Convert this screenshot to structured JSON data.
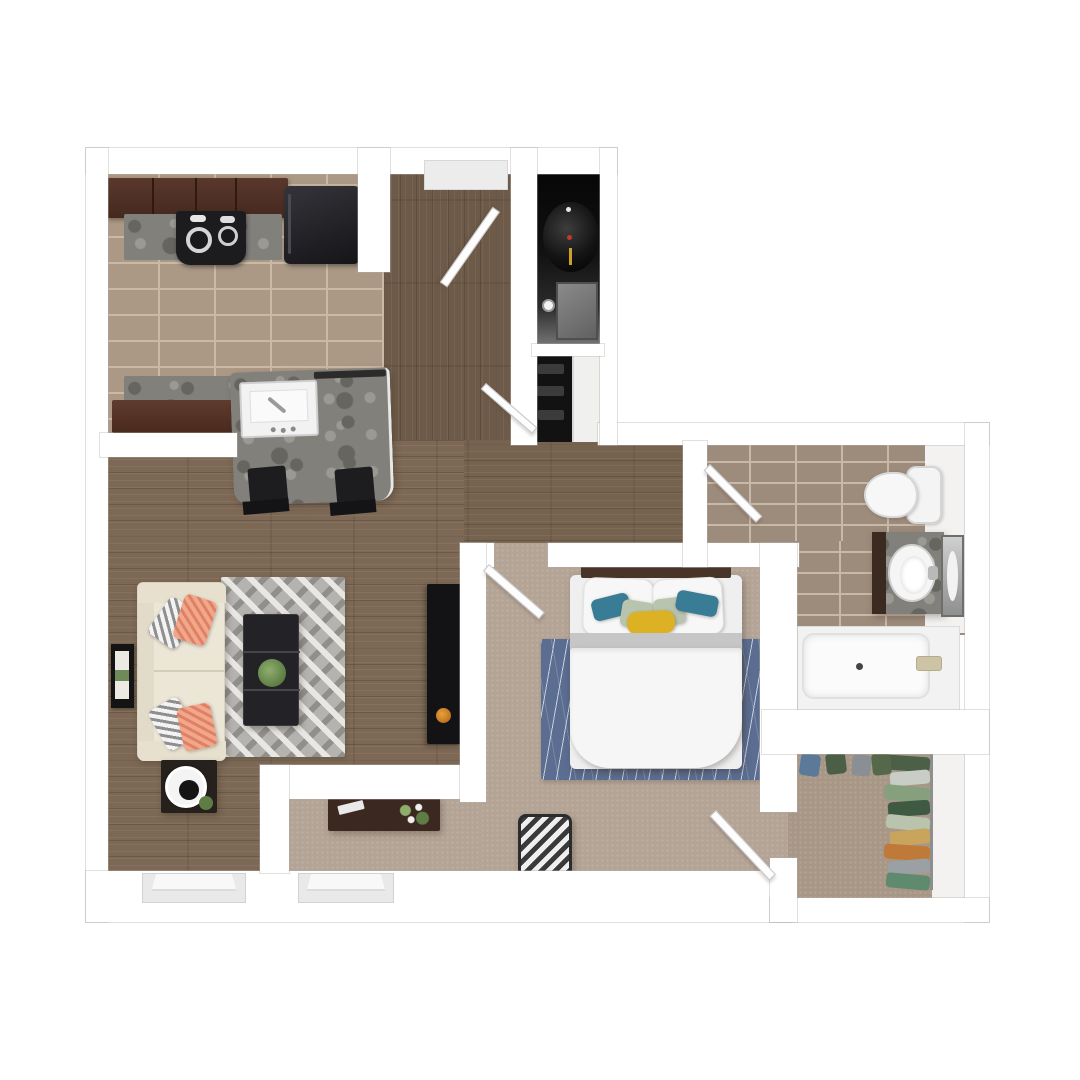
{
  "description": "Top-down 3D rendered floor plan of a one-bedroom apartment; no text labels are visible in the image",
  "visible_text": [],
  "colors": {
    "wall": "#ffffff",
    "wallEdge": "#d8d6d3",
    "woodLiving": "#7c6854",
    "woodEntry": "#6e5a48",
    "woodCorridor": "#76634f",
    "kitchenTile": "#ab9885",
    "kitchenGrout": "#c9b9a7",
    "bathTile": "#9d8b7c",
    "bathGrout": "#c7b8a7",
    "carpet": "#b4a496",
    "closetCarpet": "#a89786",
    "granite": "#82807b",
    "graniteDark": "#67655f",
    "graniteLight": "#9b9993",
    "cabinetDark": "#4a2e26",
    "cabinetMid": "#5a382c",
    "appliance": "#1c1c1f",
    "fridge": "#242428",
    "stool": "#1d1d20",
    "sofa": "#ece6d7",
    "sofaArm": "#e7e0cf",
    "sofaBack": "#e2dbc9",
    "rugGray": "#b5b3b0",
    "rugGrayDark": "#918f8c",
    "rugGrayLight": "#e9e7e4",
    "rugBlue": "#5b6d91",
    "rugBlueLine": "#c6cede",
    "pillowGrayA": "#8f8f8f",
    "pillowGrayB": "#f3f3f3",
    "pillowCoral": "#f2a78c",
    "pillowCoralStripe": "#de8264",
    "pillowTeal": "#397c95",
    "pillowSage": "#b9c4ae",
    "pillowYellow": "#dcb224",
    "headboard": "#483429",
    "furnWood": "#3b2820",
    "tableDark": "#232327",
    "plant": "#5d7d45",
    "plantLight": "#8fae6c",
    "fixtureWhite": "#f8f8f8",
    "fixtureShadow": "#d9d9d9",
    "tileWhiteStrip": "#f3f2f0",
    "doorWhite": "#fdfdfd",
    "chevronDark": "#3a3a3a",
    "chevronLight": "#efefef",
    "utilityDark": "#0d0d0d",
    "metalGray": "#767676",
    "heaterYellow": "#c9a227",
    "heaterRed": "#c0392b",
    "tubFaucetBrass": "#cdc3a5"
  },
  "rooms": {
    "kitchen": {
      "label": "Kitchen",
      "items": [
        "upper cabinets",
        "granite counter",
        "range cooktop",
        "refrigerator",
        "island with sink",
        "two bar stools"
      ]
    },
    "entry": {
      "label": "Entry hall",
      "items": [
        "front door",
        "coat closet",
        "utility closet"
      ]
    },
    "utility": {
      "label": "Utility closet",
      "items": [
        "water heater",
        "hvac unit",
        "shutoff valve"
      ]
    },
    "living": {
      "label": "Living room",
      "items": [
        "sofa",
        "throw pillows",
        "chevron area rug",
        "coffee table with plant",
        "side table with lamp",
        "tv console",
        "wall art",
        "window"
      ]
    },
    "nook": {
      "label": "Desk nook",
      "items": [
        "desk",
        "desk plant",
        "window"
      ]
    },
    "bedroom": {
      "label": "Bedroom",
      "items": [
        "bed",
        "headboard",
        "accent pillows",
        "blue area rug",
        "chevron hamper chair"
      ]
    },
    "bathroom": {
      "label": "Bathroom",
      "items": [
        "toilet",
        "granite vanity with sink",
        "mirror",
        "bathtub"
      ]
    },
    "closet": {
      "label": "Walk-in closet",
      "items": [
        "hanging clothes",
        "closet rod"
      ]
    }
  },
  "closet_clothes": [
    {
      "color": "#4c5f47"
    },
    {
      "color": "#c8cdc6"
    },
    {
      "color": "#86a07e"
    },
    {
      "color": "#3f5a42"
    },
    {
      "color": "#b9c3ae"
    },
    {
      "color": "#c9a45c"
    },
    {
      "color": "#bf7a39"
    },
    {
      "color": "#9aa0a3"
    },
    {
      "color": "#5f8a6e"
    }
  ],
  "closet_top_clothes": [
    {
      "color": "#5b7a9a"
    },
    {
      "color": "#4b5e46"
    },
    {
      "color": "#8a8f94"
    },
    {
      "color": "#55684a"
    }
  ]
}
